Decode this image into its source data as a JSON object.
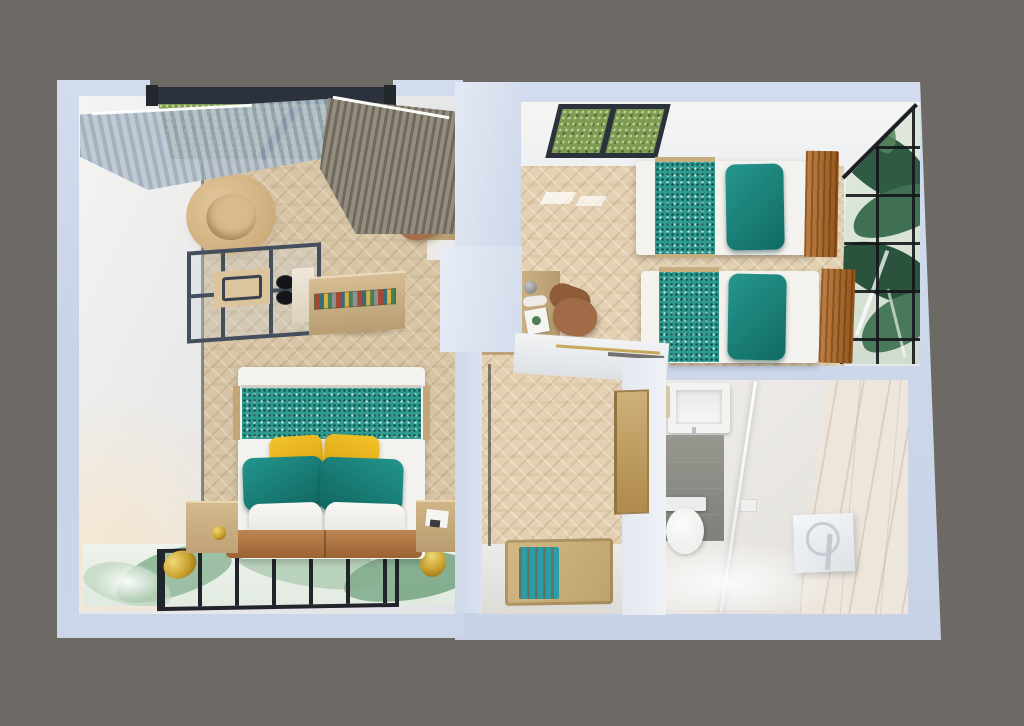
{
  "scene": {
    "type": "3d-floorplan-top-down-render",
    "description": "Photorealistic dollhouse top view of a small apartment with studio bedroom, twin bedroom, hallway and bathroom",
    "rooms": [
      {
        "name": "studio-bedroom",
        "visible_items": [
          "window-with-grass-view",
          "sheer-curtain",
          "taupe-curtain",
          "round-armchair",
          "kitchenette-glass-unit",
          "cooktop-burners",
          "sideboard",
          "decor-tray",
          "vanity-desk",
          "coffee-machine",
          "kettle",
          "desk-chair",
          "double-bed",
          "bed-runner",
          "yellow-pillows",
          "teal-pillows",
          "white-pillows",
          "headboard-cushion",
          "nightstand-left",
          "nightstand-right",
          "bedside-lamp",
          "botanical-mural-wall",
          "glass-grid-panel",
          "gold-wall-sconces"
        ]
      },
      {
        "name": "twin-bedroom",
        "visible_items": [
          "skylight-window",
          "single-bed-1",
          "single-bed-2",
          "teal-bed-runners",
          "teal-pillows",
          "leather-headboards",
          "writing-desk",
          "desk-chair",
          "monstera-mural-glass-wall"
        ]
      },
      {
        "name": "hallway",
        "visible_items": [
          "herringbone-floor",
          "entry-mat",
          "teal-striped-rug",
          "bathroom-door"
        ]
      },
      {
        "name": "bathroom",
        "visible_items": [
          "wash-basin",
          "faucet",
          "towel",
          "gray-tile-wall",
          "toilet",
          "flush-plate",
          "marble-shower-wall",
          "shower-glass-panel",
          "shower-mixer-panel"
        ]
      }
    ]
  },
  "palette": {
    "bg_gray": "#6d6a66",
    "wall_outer": "#cdd7e9",
    "wall_outer_light": "#dde4f2",
    "wall_white": "#f2f1ef",
    "floor_wood": "#d8c5a6",
    "window_frame": "#2c323c",
    "grass": "#7e9b55",
    "sheer_curtain": "#b9c5d1",
    "curtain_taupe": "#8d8577",
    "armchair_beige": "#d3b285",
    "kitchen_frame": "#454e5c",
    "counter_tan": "#c8ae85",
    "teal_runner": "#2f9a90",
    "teal_pillow": "#1f8e86",
    "yellow_pillow": "#eab821",
    "bedding_white": "#f3f2ef",
    "headboard_caramel": "#b07034",
    "nightstand_tan": "#c9af82",
    "gold": "#c8a02c",
    "mural_dark_green": "#2f5a43",
    "mural_light_green": "#86b18f",
    "grid_black": "#21242a",
    "tile_gray": "#8b8b89",
    "marble": "#ece6dd",
    "mat_beige": "#c9b07c",
    "rug_teal": "#2f9da7",
    "door_tan": "#c2a36b",
    "trim_dark": "#4a4a47"
  }
}
